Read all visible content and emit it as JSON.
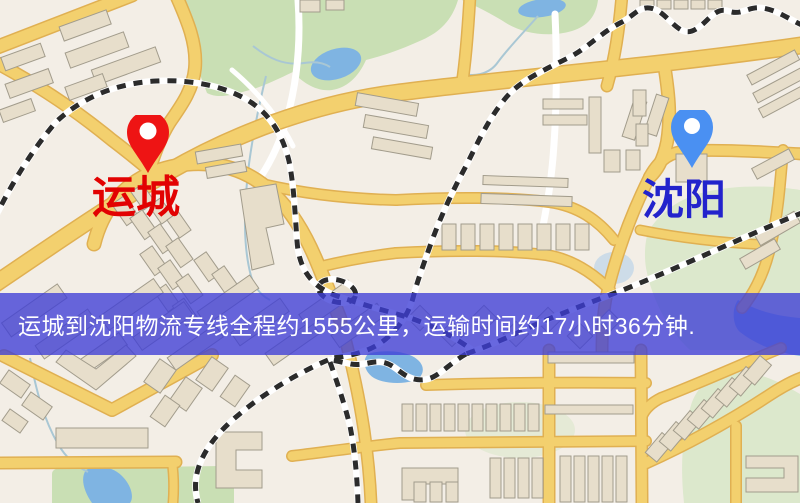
{
  "markers": {
    "origin": {
      "label": "运城",
      "icon": "red-map-pin"
    },
    "destination": {
      "label": "沈阳",
      "icon": "blue-map-pin"
    }
  },
  "banner": {
    "text": "运城到沈阳物流专线全程约1555公里，运输时间约17小时36分钟."
  },
  "colors": {
    "map_background": "#f3eee6",
    "banner_overlay": "rgba(62,62,214,0.78)",
    "banner_text": "#ffffff",
    "origin_pin": "#ee1414",
    "origin_label": "#e20202",
    "destination_pin": "#4a90f2",
    "destination_label": "#2323cc",
    "road_fill": "#f3d06e",
    "road_casing": "#e0b052",
    "park_green": "#c9dfb4",
    "water_blue": "#7fb4e2",
    "building_fill": "#e7decb",
    "railway_dark": "#2b2b2b"
  }
}
